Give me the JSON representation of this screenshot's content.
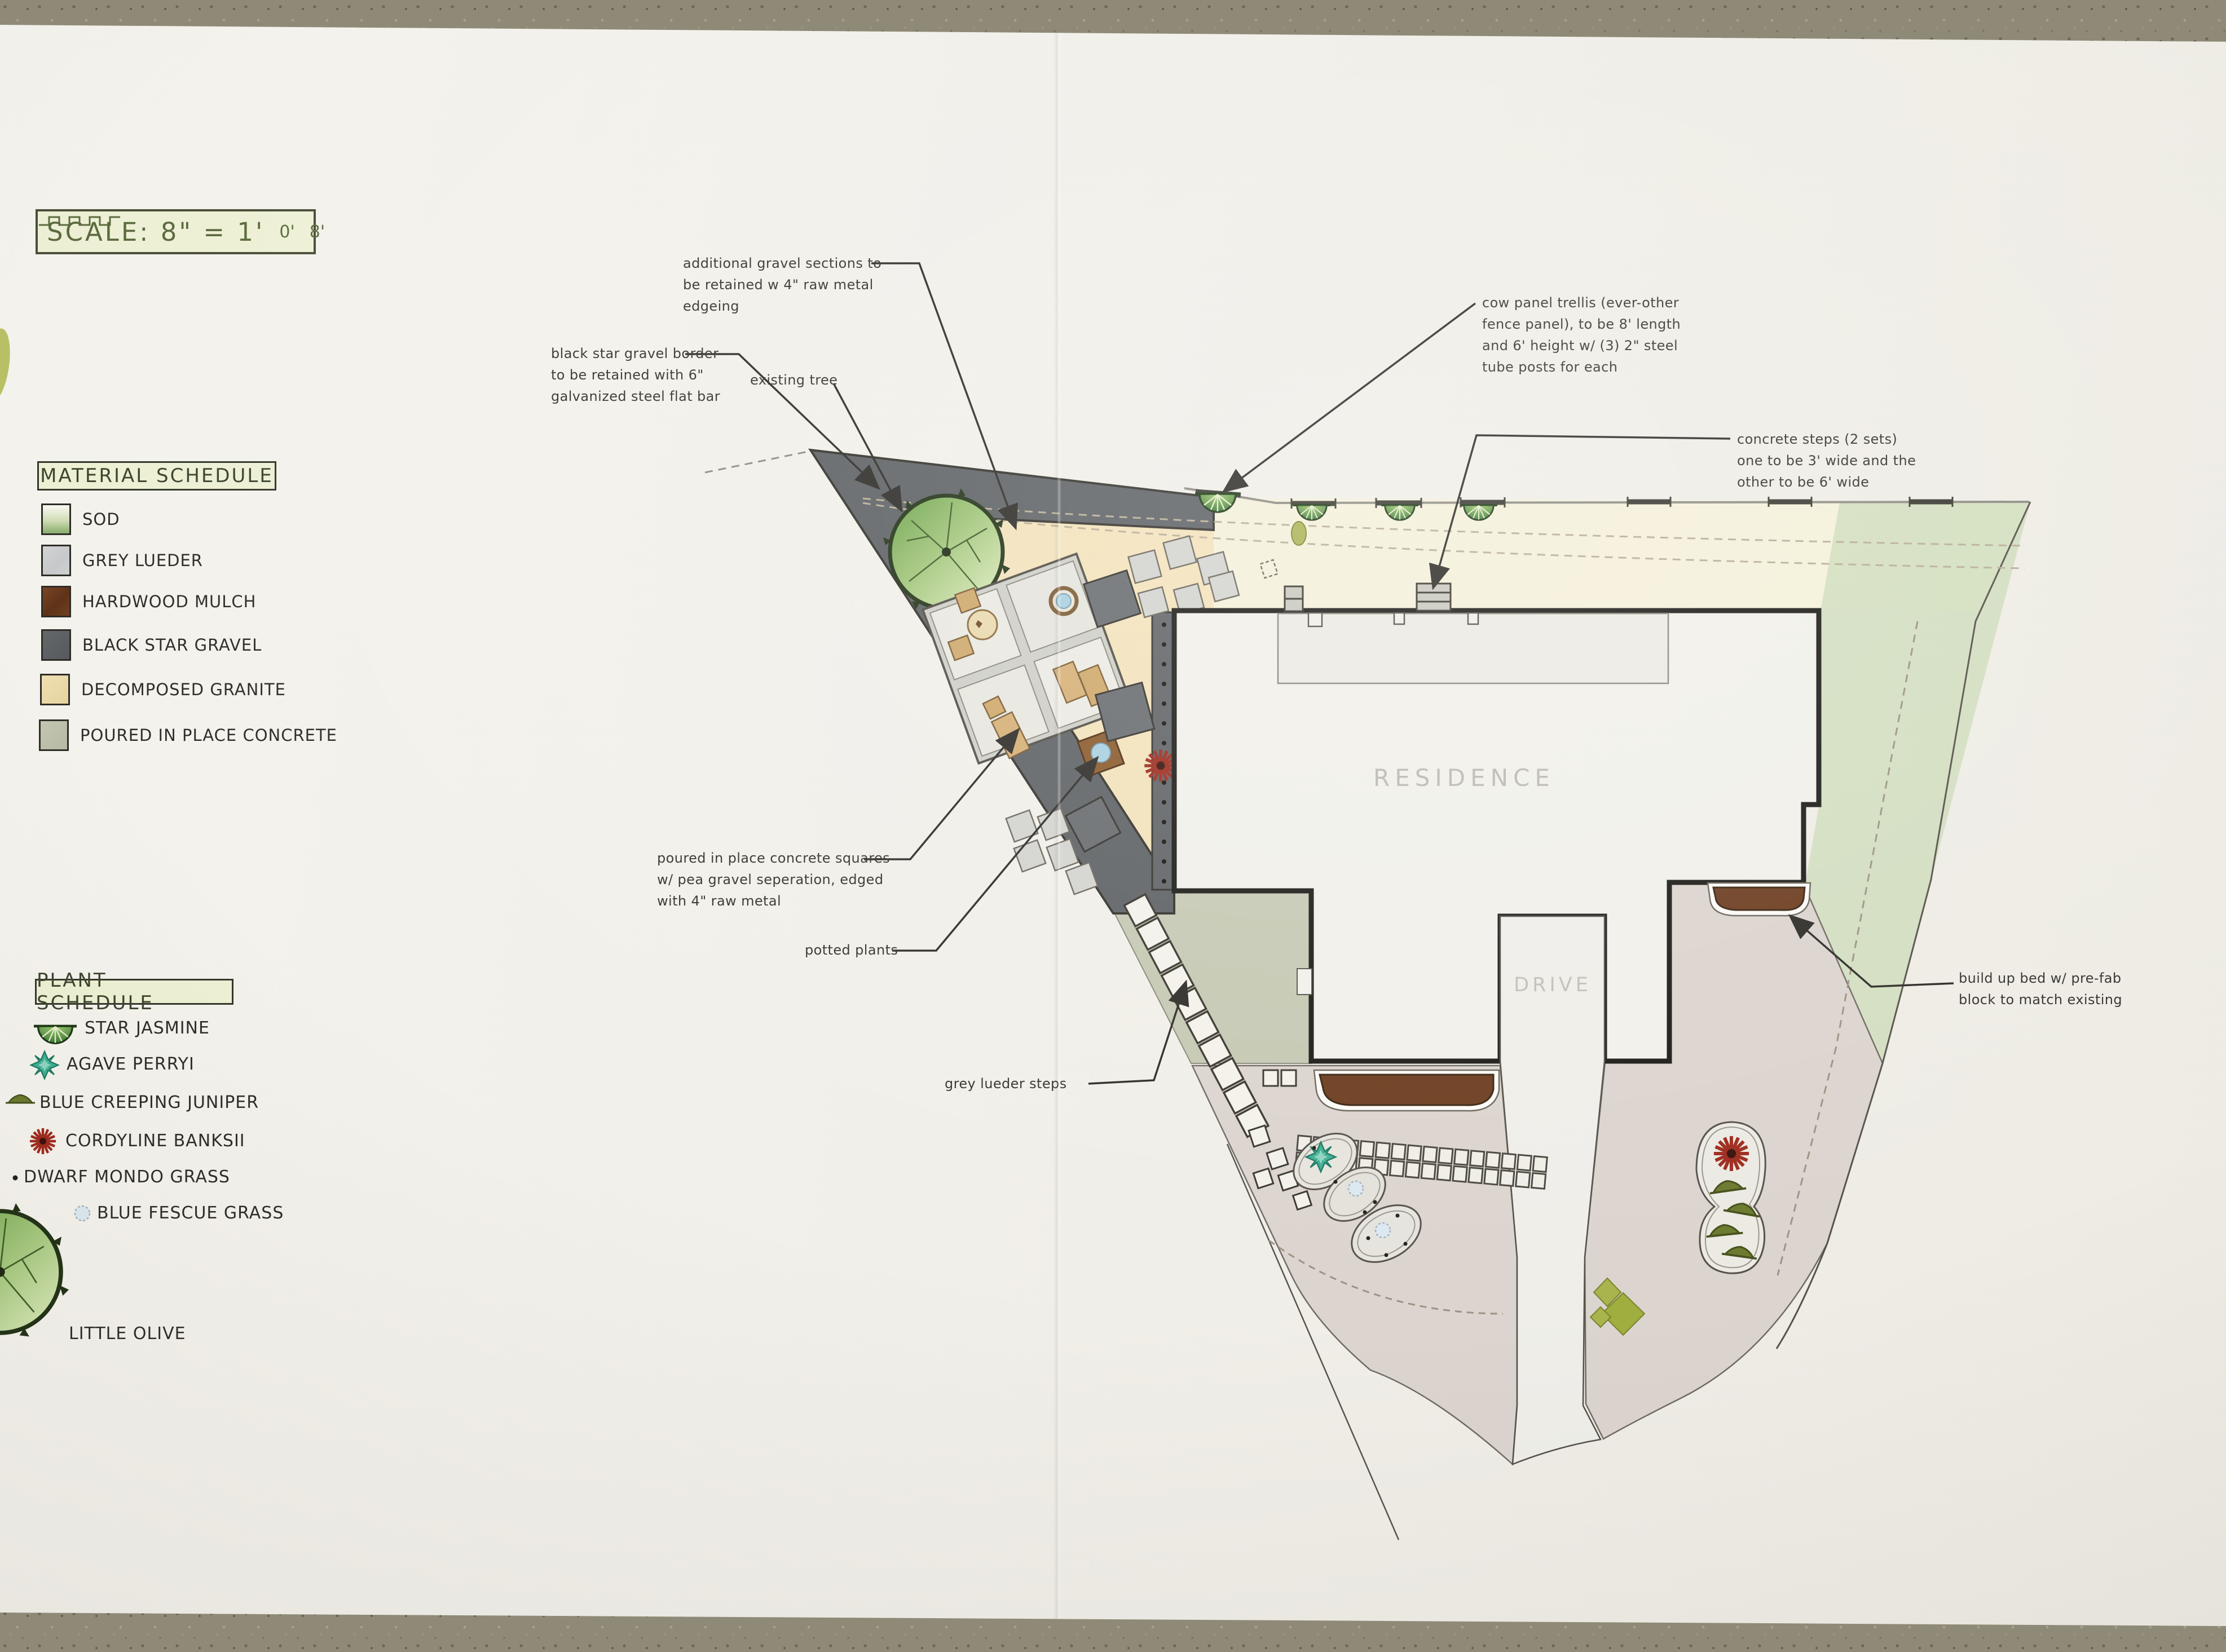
{
  "scale_bar": {
    "text": "SCALE: 8\" = 1'",
    "ruler_start": "0'",
    "ruler_end": "8'"
  },
  "material_schedule": {
    "title": "MATERIAL SCHEDULE",
    "items": [
      {
        "label": "SOD"
      },
      {
        "label": "GREY LUEDER"
      },
      {
        "label": "HARDWOOD MULCH"
      },
      {
        "label": "BLACK STAR GRAVEL"
      },
      {
        "label": "DECOMPOSED GRANITE"
      },
      {
        "label": "POURED IN PLACE CONCRETE"
      }
    ]
  },
  "plant_schedule": {
    "title": "PLANT SCHEDULE",
    "items": [
      {
        "label": "STAR JASMINE"
      },
      {
        "label": "AGAVE PERRYI"
      },
      {
        "label": "BLUE CREEPING JUNIPER"
      },
      {
        "label": "CORDYLINE BANKSII"
      },
      {
        "label": "DWARF MONDO GRASS"
      },
      {
        "label": "BLUE FESCUE GRASS"
      },
      {
        "label": "LITTLE OLIVE"
      }
    ]
  },
  "plan": {
    "residence_label": "RESIDENCE",
    "drive_label": "DRIVE",
    "annotations": [
      {
        "id": "additional-gravel",
        "text": "additional gravel sections to\nbe retained w 4\" raw metal\nedgeing"
      },
      {
        "id": "black-star-border",
        "text": "black star gravel border\nto be retained with 6\"\ngalvanized steel flat bar"
      },
      {
        "id": "existing-tree",
        "text": "existing tree"
      },
      {
        "id": "cow-panel-trellis",
        "text": "cow panel trellis (ever-other\nfence panel), to be 8' length\nand 6' height w/ (3) 2\" steel\ntube posts for each"
      },
      {
        "id": "concrete-steps",
        "text": "concrete steps (2 sets)\none to be 3' wide and the\nother to be 6' wide"
      },
      {
        "id": "poured-squares",
        "text": "poured in place concrete squares\nw/ pea gravel seperation, edged\nwith 4\" raw metal"
      },
      {
        "id": "potted-plants",
        "text": "potted plants"
      },
      {
        "id": "grey-lueder-steps",
        "text": "grey lueder steps"
      },
      {
        "id": "build-up-bed",
        "text": "build up bed w/ pre-fab\nblock to match existing"
      }
    ]
  },
  "colors": {
    "table": "#8f8a77",
    "paper": "#f1efe9",
    "schedule_box": "#edf0d3",
    "scale_text": "#5c6b3f",
    "sod": "#8fb273",
    "grey_lueder": "#ccced0",
    "hardwood_mulch": "#6d3d20",
    "black_star_gravel": "#5e6265",
    "decomposed_granite": "#eddcab",
    "poured_concrete": "#c2c6b0",
    "sod_wash": "#ccdbb8",
    "paving": "#dbd3cd",
    "agave": "#3fae93",
    "cordyline": "#9e2b1e",
    "tree_green": "#6fa548",
    "line": "#2e2c28"
  }
}
